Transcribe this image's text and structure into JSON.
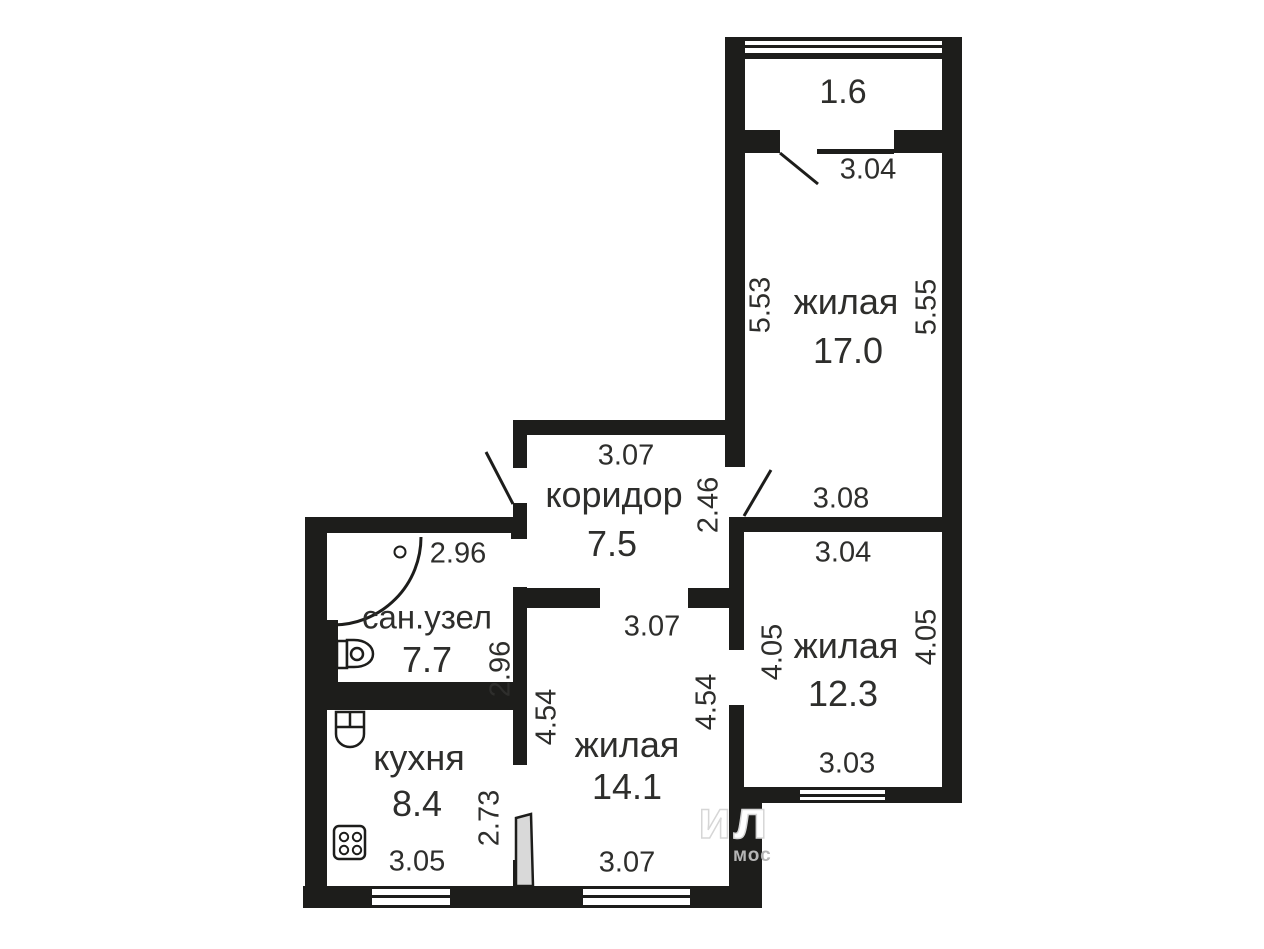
{
  "colors": {
    "wall": "#1d1d1b",
    "text": "#2e2e2c",
    "door_leaf_fill": "#d9d9d9",
    "watermark": "#b5b5b5"
  },
  "rooms": {
    "balcony": {
      "area": "1.6",
      "dim_bottom": "3.04"
    },
    "living17": {
      "label": "жилая",
      "area": "17.0",
      "dim_left": "5.53",
      "dim_right": "5.55",
      "dim_bottom": "3.08"
    },
    "corridor": {
      "label": "коридор",
      "area": "7.5",
      "dim_top": "3.07",
      "dim_right": "2.46"
    },
    "living12": {
      "label": "жилая",
      "area": "12.3",
      "dim_top": "3.04",
      "dim_left": "4.05",
      "dim_right": "4.05",
      "dim_bottom": "3.03"
    },
    "bathroom": {
      "label": "сан.узел",
      "area": "7.7",
      "dim_top": "2.96",
      "dim_right": "2.96"
    },
    "living14": {
      "label": "жилая",
      "area": "14.1",
      "dim_top": "3.07",
      "dim_left": "4.54",
      "dim_right": "4.54",
      "dim_bottom": "3.07"
    },
    "kitchen": {
      "label": "кухня",
      "area": "8.4",
      "dim_bottom": "3.05",
      "dim_right": "2.73"
    }
  },
  "watermark": {
    "large": "ил",
    "small": "мос"
  }
}
